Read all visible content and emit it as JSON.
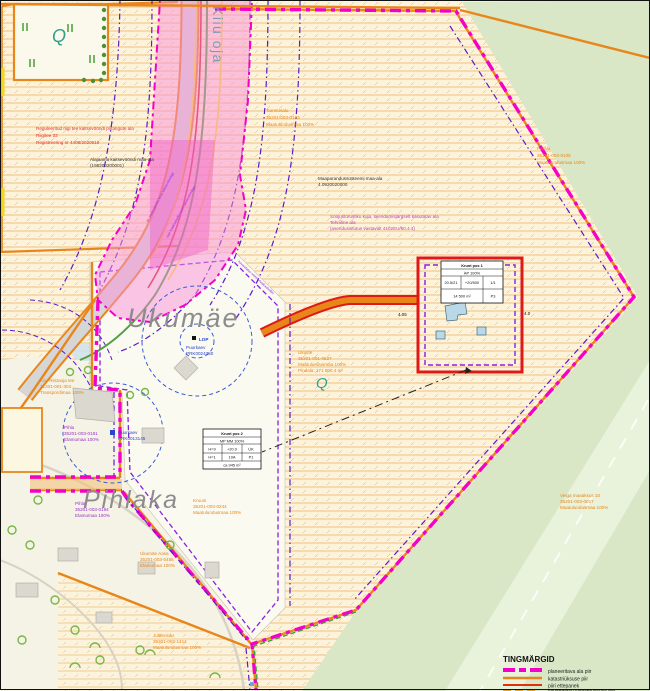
{
  "map": {
    "stream_label": "Kiiu oja",
    "places": {
      "ukumae": "Ukumäe",
      "pihlaka": "Pihlaka"
    },
    "dimensions": {
      "d1": "4.05",
      "d2": "4.0"
    },
    "notes": {
      "road_restriction": [
        "Reguleeritud riigi tee kaitsevööndi piirangute ala",
        "Riigitee 33",
        "Registreering nr 4408/2020618"
      ],
      "substation": [
        "Alajaama kaitsevööndi maa-ala",
        "(198200200001)"
      ],
      "drainage": [
        "Maaparandussüsteemi maa-ala",
        "4.0920020000"
      ],
      "heating": [
        "Soojustorustiku kuja, laiendamisjärgselt kasutatav ala",
        "Tehniline ala",
        "(asendusistutus vastavalt 4102EU/50.4.1)"
      ]
    },
    "parcels": {
      "tammetalu": [
        "Tammetalu",
        "35201-003-0123",
        "Maatulundusmaa 100%"
      ],
      "parala": [
        "Parala",
        "35201-003-0105",
        "Maatulundusmaa 100%"
      ],
      "ukuste": [
        "Ukuste",
        "35201-001-0527",
        "Maatulundusmaa 100%",
        "Pindala: 171 800.4 m²"
      ],
      "veiga": [
        "Veiga maaüksus 10",
        "35201-003-0017",
        "Maatulundusmaa 100%"
      ],
      "kruusi": [
        "Kruusi",
        "35201-003-0244",
        "Maatulundusmaa 100%"
      ],
      "kiiu_tee": [
        "Kiiu-Riistaoja tee",
        "31201-001-304",
        "Transpordimaa 100%"
      ],
      "pihla1": [
        "Pihla",
        "35201-003-0181",
        "Elamumaa 100%"
      ],
      "pihla2": [
        "Pihla",
        "35201-003-0194",
        "Elamumaa 100%"
      ],
      "ukumae_aasa": [
        "Ukumäe Aasa",
        "35201-003-0456",
        "Elamumaa 100%"
      ],
      "juttleniidu": [
        "Juttleniidu",
        "35201-003-1414",
        "Maatulundusmaa 100%"
      ]
    },
    "wells": {
      "well1": [
        "LOP",
        "Puurkaev",
        "PRK0024350"
      ],
      "well2": [
        "Puurkaev",
        "PRK0013145"
      ]
    },
    "utility_labels": {
      "u1": "el. maakaabelliin koos kaitsevööndiga",
      "u2": "side maakaabelliin koos kaitsevööndiga",
      "u3": "kavandatav elektri maakaabelliin"
    },
    "symbols": {
      "spring": "Q"
    }
  },
  "tables": {
    "pos1": {
      "title": "Krunt pos 1",
      "use": "ÄP 100%",
      "cells": [
        "20.5/21",
        "+20/500",
        "1/1"
      ],
      "area": "14 500 m²",
      "code": "P3"
    },
    "pos2": {
      "title": "Krunt pos 2",
      "use": "MP MM 100%",
      "row2": [
        "H=9",
        "+20.0",
        "ÜK"
      ],
      "row3": [
        "H=1",
        "10A",
        "P1"
      ],
      "area": "ca 945 m²"
    }
  },
  "legend": {
    "title": "TINGMÄRGID",
    "items": [
      {
        "label": "planeeritava ala piir",
        "swatch": "magenta-dashed"
      },
      {
        "label": "katastriüksuse piir",
        "swatch": "orange-line"
      },
      {
        "label": "piiri ettepanek",
        "swatch": "red-line"
      },
      {
        "label": "kavandatav katastriüksuse piir",
        "swatch": "orange-dashed"
      }
    ]
  },
  "colors": {
    "planning_boundary": "#f400c8",
    "cadastral_line": "#e8861a",
    "proposed_line": "#e01818",
    "utility_purple": "#5a1cc8",
    "green_area": "#d9e7c6",
    "pink_zone": "#f98fd8",
    "hatch_base": "#fcf3da"
  }
}
